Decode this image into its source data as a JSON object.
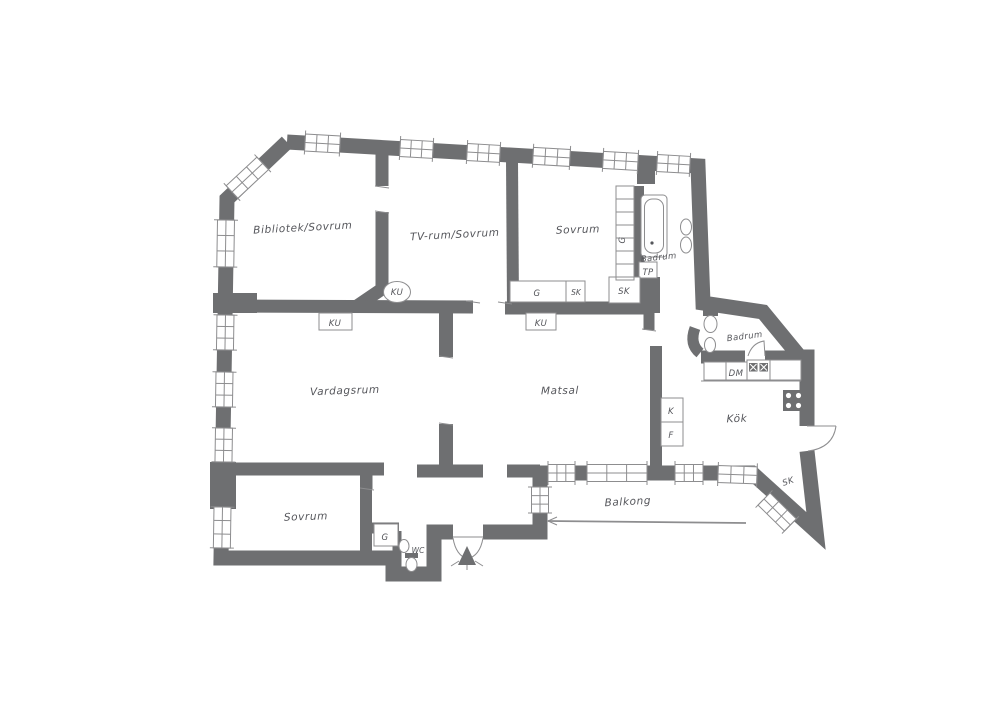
{
  "floorplan": {
    "labels": {
      "bibliotek_sovrum": "Bibliotek/Sovrum",
      "tv_rum_sovrum": "TV-rum/Sovrum",
      "sovrum_1": "Sovrum",
      "badrum_1": "Badrum",
      "badrum_2": "Badrum",
      "vardagsrum": "Vardagsrum",
      "matsal": "Matsal",
      "kok": "Kök",
      "sovrum_2": "Sovrum",
      "balkong": "Balkong",
      "wc": "WC",
      "garderob_sovrum1": "G",
      "garderob_strip": "G",
      "garderob_sovrum2": "G",
      "sk_sovrum1": "SK",
      "sk_korridor": "SK",
      "sk_balkong": "SK",
      "tp": "TP",
      "kakelugn_circle": "KU",
      "kakelugn_vardagsrum": "KU",
      "kakelugn_matsal": "KU",
      "dm": "DM",
      "kyl": "K",
      "frys": "F"
    },
    "icons": [
      "bathtub-icon",
      "toilet-icon",
      "sink-icon",
      "stove-icon",
      "kitchen-sink-icon",
      "entrance-arrow-icon",
      "door-arc-icon",
      "window-icon",
      "laundry-ovals-icon"
    ],
    "colors": {
      "wall": "#6e6f71",
      "line": "#8d8d8f",
      "text": "#55565b",
      "background": "#ffffff"
    }
  }
}
